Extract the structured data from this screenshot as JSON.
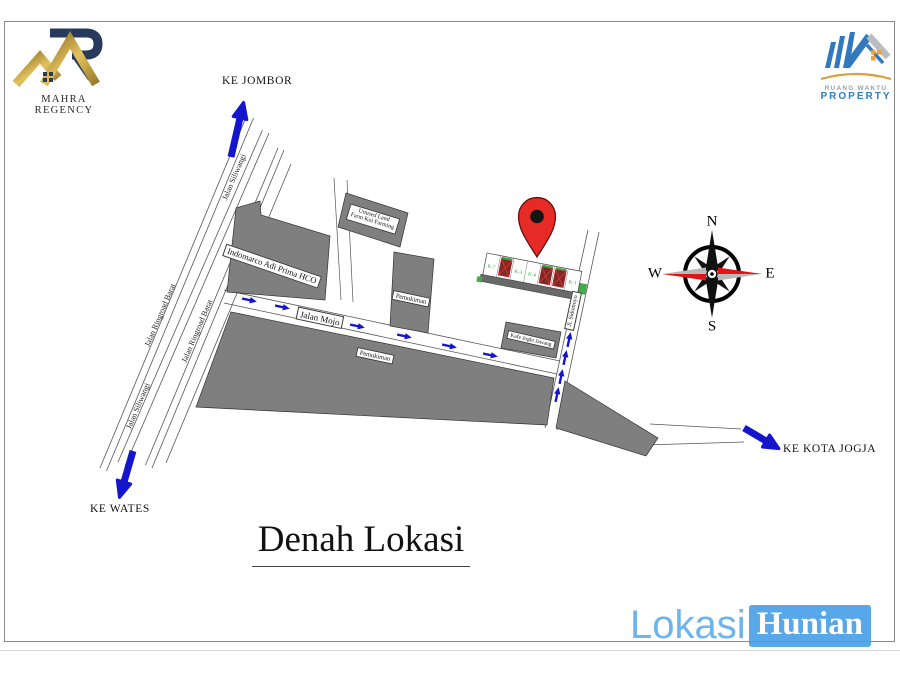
{
  "header": {
    "mahra_text": "MAHRA REGENCY",
    "rw_line1": "RUANG WAKTU",
    "rw_line2": "PROPERTY"
  },
  "title": {
    "text": "Denah Lokasi"
  },
  "watermark": {
    "lokasi": "Lokasi",
    "hunian": "Hunian"
  },
  "directions": {
    "jombor": "KE JOMBOR",
    "wates": "KE WATES",
    "jogja": "KE KOTA JOGJA"
  },
  "roads": {
    "siliwangi_top": "Jalan Siliwangi",
    "siliwangi_bottom": "Jalan Siliwangi",
    "ringroad_left": "Jalan Ringroad Barat",
    "ringroad_right": "Jalan Ringroad Barat",
    "mojo": "Jalan Mojo",
    "sidomoyo": "Jl. Sidomoyo"
  },
  "buildings": {
    "indomarco": "Indomarco Adi Prima HCO",
    "unused_land_line1": "Unused Land",
    "unused_land_line2": "Farm Koi Farming",
    "pemukiman_north": "Pemukiman",
    "pemukiman_south": "Pemukiman",
    "joglo": "Kafe Joglo Jawang"
  },
  "compass": {
    "n": "N",
    "e": "E",
    "s": "S",
    "w": "W"
  },
  "site": {
    "lots": [
      {
        "label": "K-7",
        "sold": false
      },
      {
        "label": "",
        "sold": true
      },
      {
        "label": "K-3",
        "sold": false
      },
      {
        "label": "K-4",
        "sold": false
      },
      {
        "label": "",
        "sold": true
      },
      {
        "label": "",
        "sold": true
      },
      {
        "label": "K-1",
        "sold": false
      }
    ]
  },
  "colors": {
    "arrow_blue": "#1515cd",
    "building_gray": "#7f7f7f",
    "pin_red": "#e62a25",
    "lot_green": "#2aa03a",
    "watermark_blue": "#6db5ec",
    "gold": "#c9a23a",
    "navy": "#27395d"
  }
}
